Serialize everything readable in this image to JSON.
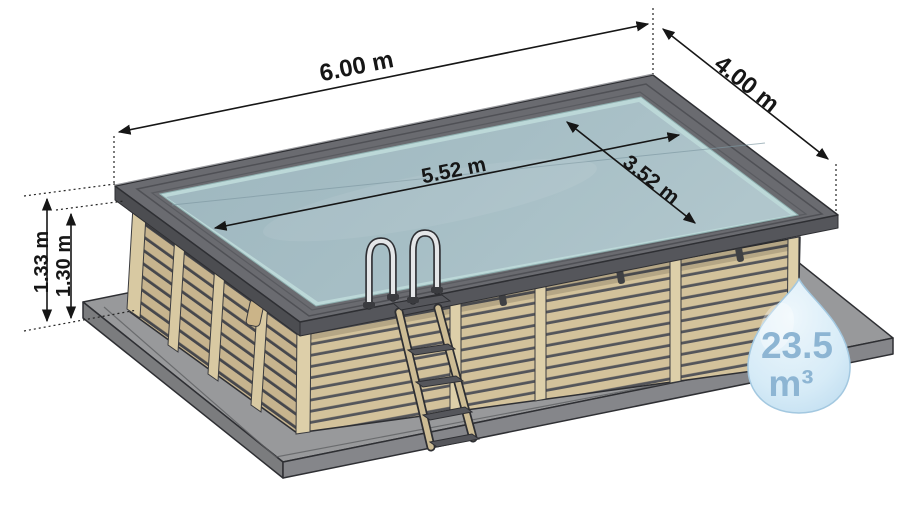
{
  "diagram": {
    "subject": "wooden-rectangular-pool-dimension-diagram",
    "labels": {
      "outer_length": "6.00 m",
      "outer_width": "4.00 m",
      "inner_length": "5.52 m",
      "inner_width": "3.52 m",
      "height_total": "1.33 m",
      "height_water": "1.30 m"
    },
    "volume": {
      "value": "23.5",
      "unit": "m³"
    },
    "colors": {
      "water": "#a2bac2",
      "water_light": "#b0c6cc",
      "liner_edge": "#bcd8d8",
      "wood_slat": "#d3c29b",
      "wood_slat_shaded": "#c7b48e",
      "wood_post": "#ddcfa9",
      "rim_gray": "#6a6b70",
      "slab_gray": "#98999b",
      "dimension_ink": "#161616",
      "droplet_fill": "#cfe6f4",
      "droplet_text": "#8db5d3"
    }
  }
}
